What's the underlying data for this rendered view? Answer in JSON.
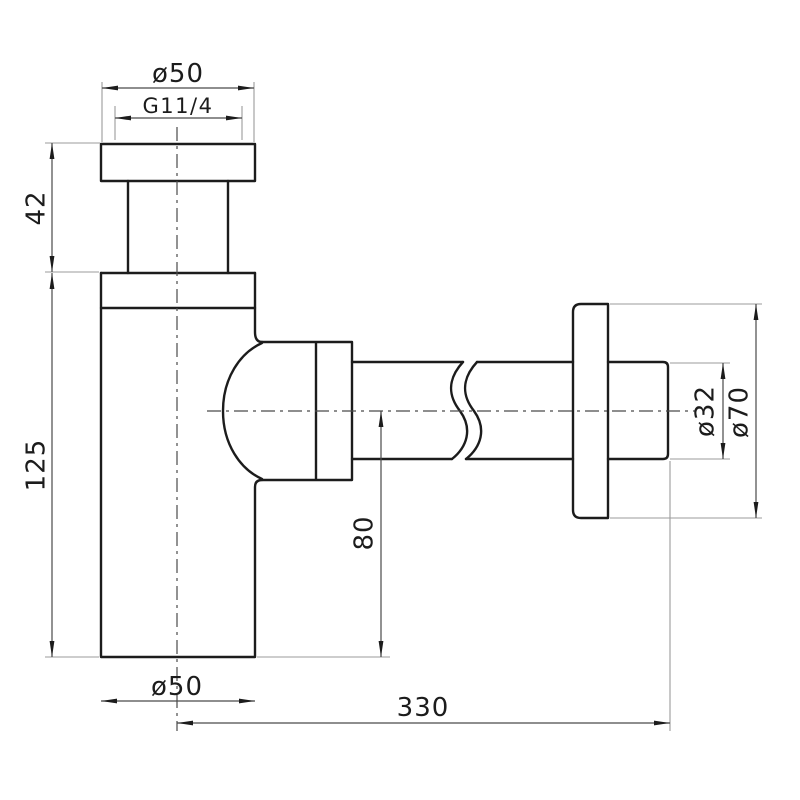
{
  "document": {
    "type": "technical-drawing",
    "subject": "bottle trap siphon side view with dimensions",
    "units": "mm"
  },
  "colors": {
    "background": "#ffffff",
    "outline": "#1c1c1c",
    "dimension_line": "#4a4a4a",
    "extension_line": "#9b9b9b",
    "text": "#1c1c1c"
  },
  "dimensions": {
    "cap_diameter": {
      "label": "ø50"
    },
    "thread_size": {
      "label": "G11/4"
    },
    "cap_to_body_height": {
      "label": "42"
    },
    "body_height": {
      "label": "125"
    },
    "body_diameter": {
      "label": "ø50"
    },
    "axis_to_bottom": {
      "label": "80"
    },
    "outlet_length": {
      "label": "330"
    },
    "pipe_diameter": {
      "label": "ø32"
    },
    "flange_diameter": {
      "label": "ø70"
    }
  }
}
